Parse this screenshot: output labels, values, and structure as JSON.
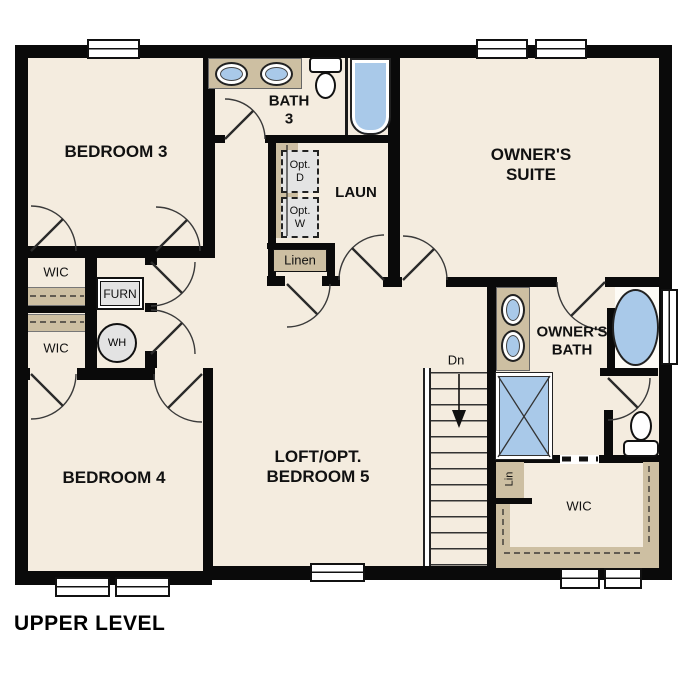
{
  "title": "UPPER LEVEL",
  "colors": {
    "floor": "#f4ecdf",
    "wall": "#0a0a0a",
    "fixture_blue": "#a9c9e9",
    "cabinet_tan": "#cdbfa2",
    "appliance_gray": "#e3e3e3"
  },
  "rooms": {
    "bedroom3": {
      "label": "BEDROOM 3"
    },
    "bath3": {
      "line1": "BATH",
      "line2": "3"
    },
    "owners_suite": {
      "line1": "OWNER'S",
      "line2": "SUITE"
    },
    "laundry": {
      "label": "LAUN"
    },
    "wic_bed3": {
      "label": "WIC"
    },
    "wic_bed4": {
      "label": "WIC"
    },
    "furnace": {
      "label": "FURN"
    },
    "water_heater": {
      "label": "WH"
    },
    "linen": {
      "label": "Linen"
    },
    "bedroom4": {
      "label": "BEDROOM 4"
    },
    "loft": {
      "line1": "LOFT/OPT.",
      "line2": "BEDROOM 5"
    },
    "owners_bath": {
      "line1": "OWNER'S",
      "line2": "BATH"
    },
    "wic_owners": {
      "label": "WIC"
    },
    "linen_small": {
      "label": "Lin"
    },
    "stairs": {
      "label": "Dn"
    },
    "opt_dryer": {
      "line1": "Opt.",
      "line2": "D"
    },
    "opt_washer": {
      "line1": "Opt.",
      "line2": "W"
    }
  }
}
